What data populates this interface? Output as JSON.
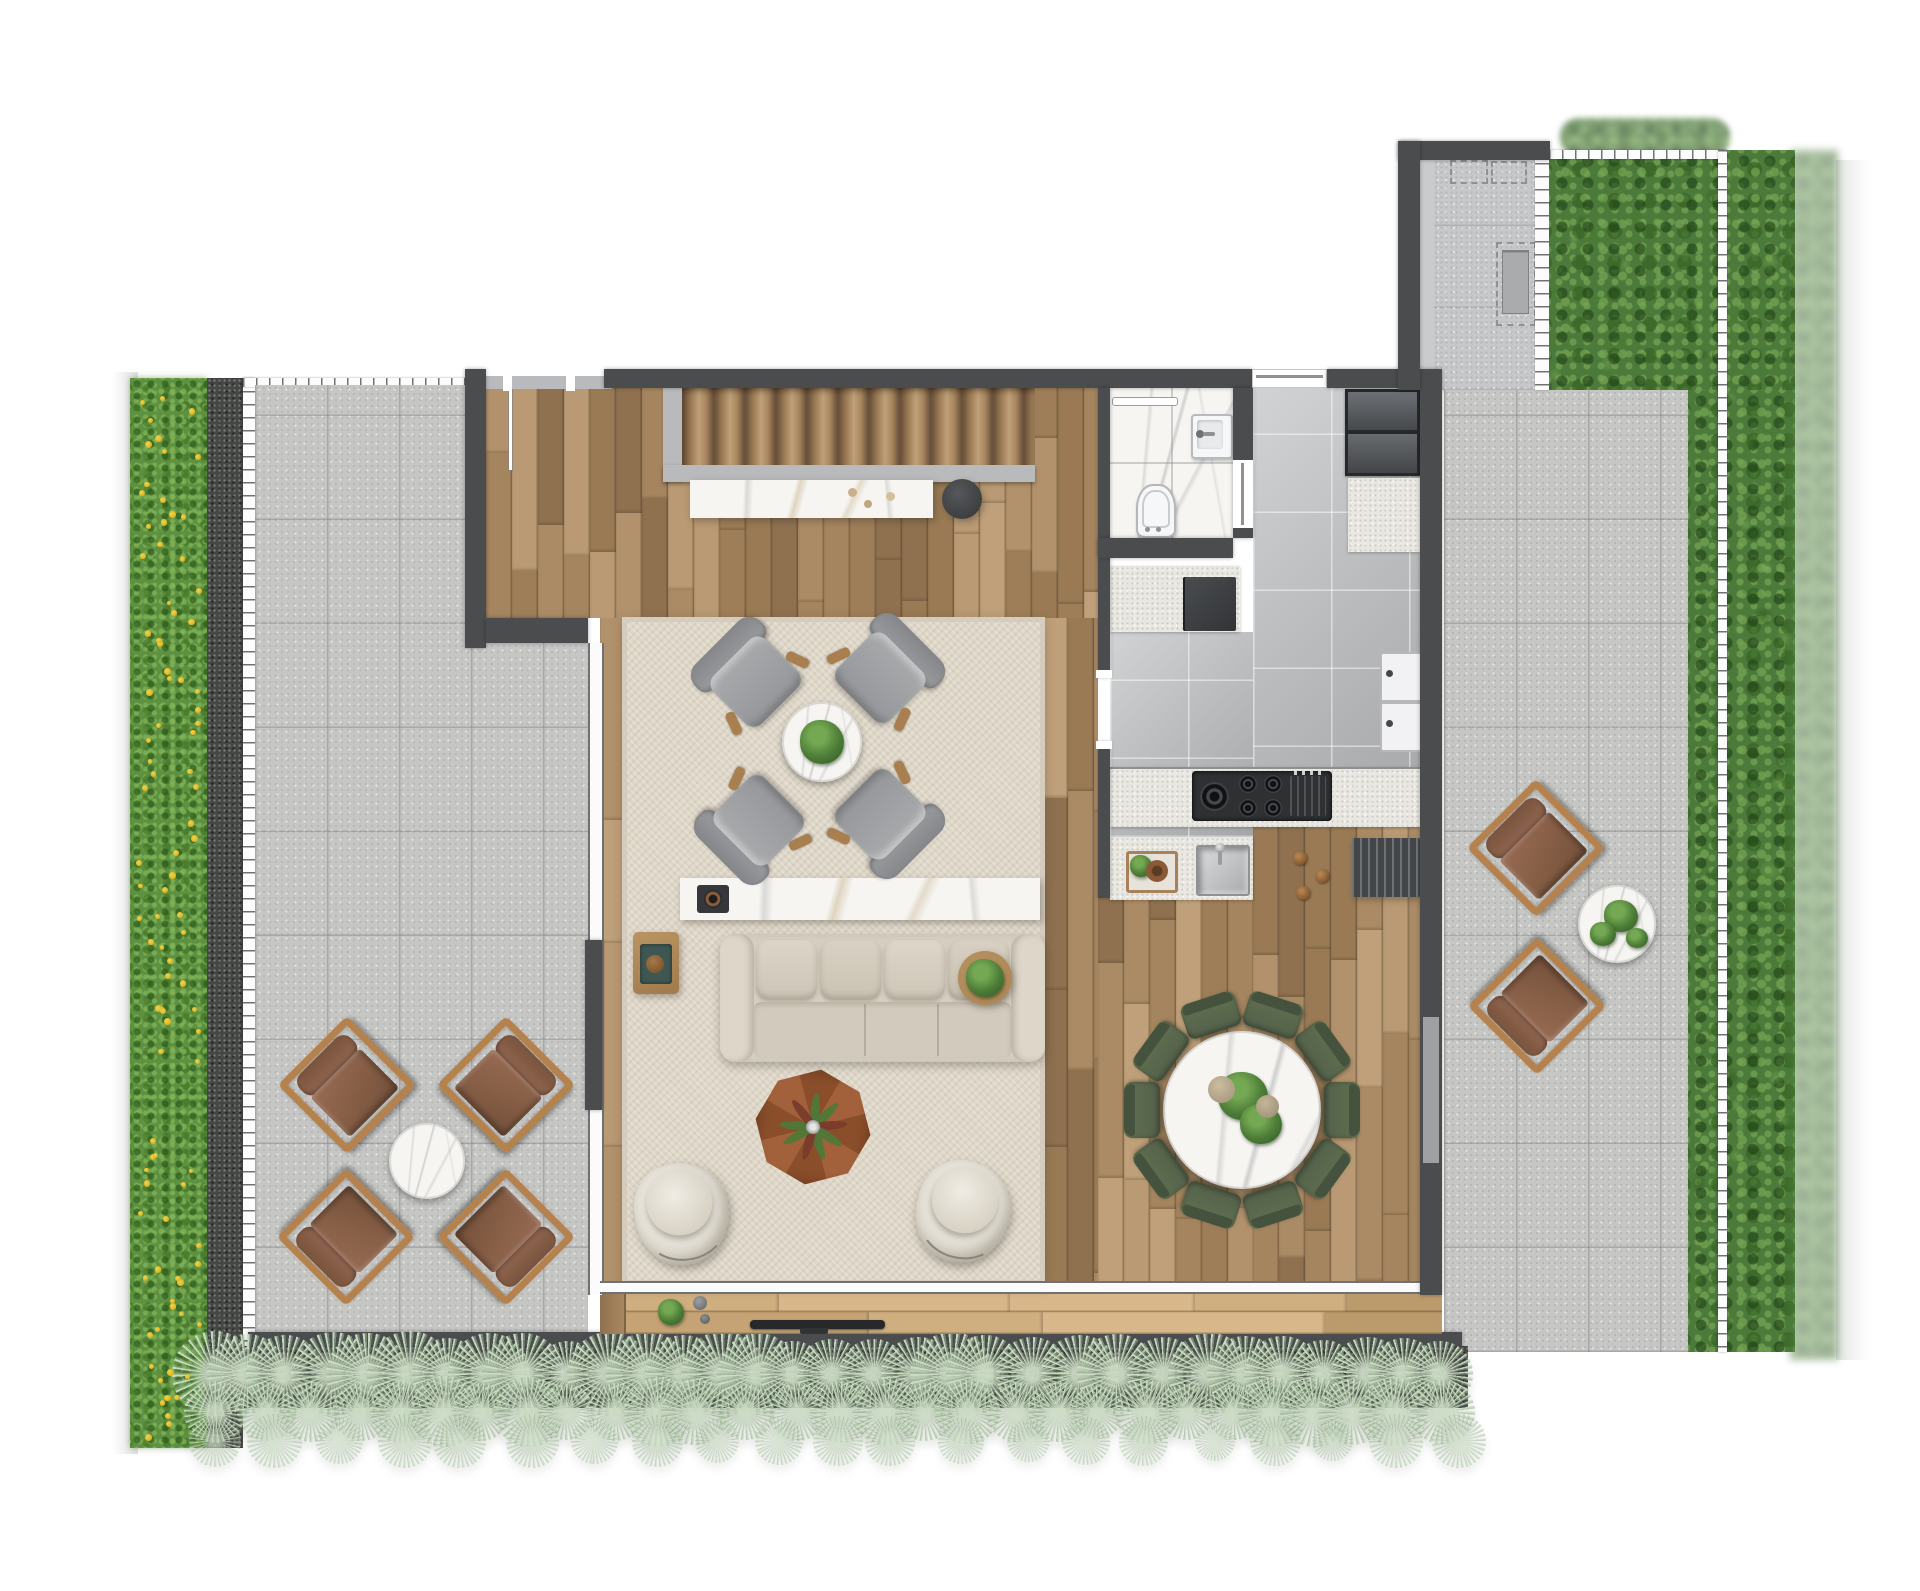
{
  "meta": {
    "kind": "architectural-floor-plan",
    "canvas_w": 1920,
    "canvas_h": 1591,
    "visible_text": "none"
  },
  "palette": {
    "wall": "#4a4c4e",
    "paver": "#c6c7c5",
    "kitchen_tile": "#b7b9bb",
    "rug": "#ded6c7",
    "marble": "#f6f5f2",
    "hedge_green": "#5d9140",
    "foliage_green": "#4c7a3b",
    "grass_light": "#cdddc6",
    "grass_mid": "#93b28b",
    "gravel": "#3a3c38",
    "sofa": "#d6cfc1",
    "armchair_gray": "#9a9c9e",
    "dining_chair_green": "#5d6b52",
    "outdoor_cushion": "#8a6049",
    "outdoor_frame": "#b5824d",
    "flower_yellow": "#e9c832",
    "wood_tones": [
      "#b99a74",
      "#ab8b65",
      "#9e7e59",
      "#b2926c",
      "#a5855f",
      "#8f7150",
      "#bfa07a",
      "#997a55"
    ],
    "deck_tones": [
      "#cfae80",
      "#c5a374",
      "#d8b88a",
      "#bb9a6c"
    ]
  },
  "inventory": {
    "rooms": [
      "left-terrace",
      "living-room",
      "kitchen",
      "bathroom",
      "dining-area",
      "right-terrace",
      "utility-corridor",
      "south-deck"
    ],
    "living_armchairs": 4,
    "outdoor_armchairs_left": 4,
    "outdoor_armchairs_right": 2,
    "dining_chairs": 10,
    "cream_lounge_chairs": 2,
    "sofas": 1,
    "round_tables": 4,
    "staircase_steps": 12
  },
  "generators": {
    "planks": [
      {
        "target": "wood-a",
        "dir": "v",
        "size": 26,
        "min": 110,
        "max": 300
      },
      {
        "target": "wood-b",
        "dir": "v",
        "size": 26,
        "min": 110,
        "max": 300
      },
      {
        "target": "wood-c1",
        "dir": "v",
        "size": 26,
        "min": 110,
        "max": 300
      },
      {
        "target": "wood-c2",
        "dir": "v",
        "size": 26,
        "min": 110,
        "max": 300
      },
      {
        "target": "deck",
        "dir": "h",
        "size": 22,
        "min": 140,
        "max": 300,
        "palette": "deck_tones"
      }
    ],
    "grass": {
      "x0": 215,
      "x1": 1462,
      "rows": [
        {
          "y": 1374,
          "smin": 64,
          "smax": 88,
          "step": 40,
          "op": 1
        },
        {
          "y": 1412,
          "smin": 54,
          "smax": 74,
          "step": 44,
          "op": 0.95
        },
        {
          "y": 1441,
          "smin": 40,
          "smax": 56,
          "step": 62,
          "op": 0.75
        }
      ]
    },
    "flowers": {
      "x": 136,
      "y": 384,
      "w": 66,
      "h": 1058,
      "count": 95
    },
    "leafblob_targets": [
      "green-ne",
      "hedge-right"
    ]
  },
  "furniture": {
    "living_armchairs": [
      {
        "x": 750,
        "y": 676,
        "r": -45
      },
      {
        "x": 886,
        "y": 672,
        "r": 45
      },
      {
        "x": 753,
        "y": 826,
        "r": -135
      },
      {
        "x": 886,
        "y": 820,
        "r": 135
      }
    ],
    "left_terrace_chairs": [
      {
        "x": 347,
        "y": 1085,
        "r": -45
      },
      {
        "x": 506,
        "y": 1085,
        "r": 45
      },
      {
        "x": 346,
        "y": 1237,
        "r": -135
      },
      {
        "x": 506,
        "y": 1237,
        "r": 135
      }
    ],
    "right_terrace_chairs": [
      {
        "x": 1536,
        "y": 848,
        "r": -45
      },
      {
        "x": 1537,
        "y": 1006,
        "r": -135
      }
    ],
    "cream_chairs": [
      {
        "x": 682,
        "y": 1214,
        "r": -8
      },
      {
        "x": 963,
        "y": 1212,
        "r": 14
      }
    ],
    "dining": {
      "cx": 1242,
      "cy": 1110,
      "table_r": 79,
      "chair_count": 10,
      "ring_r": 100,
      "start_angle": -108,
      "cw": 56,
      "ch": 36
    }
  }
}
